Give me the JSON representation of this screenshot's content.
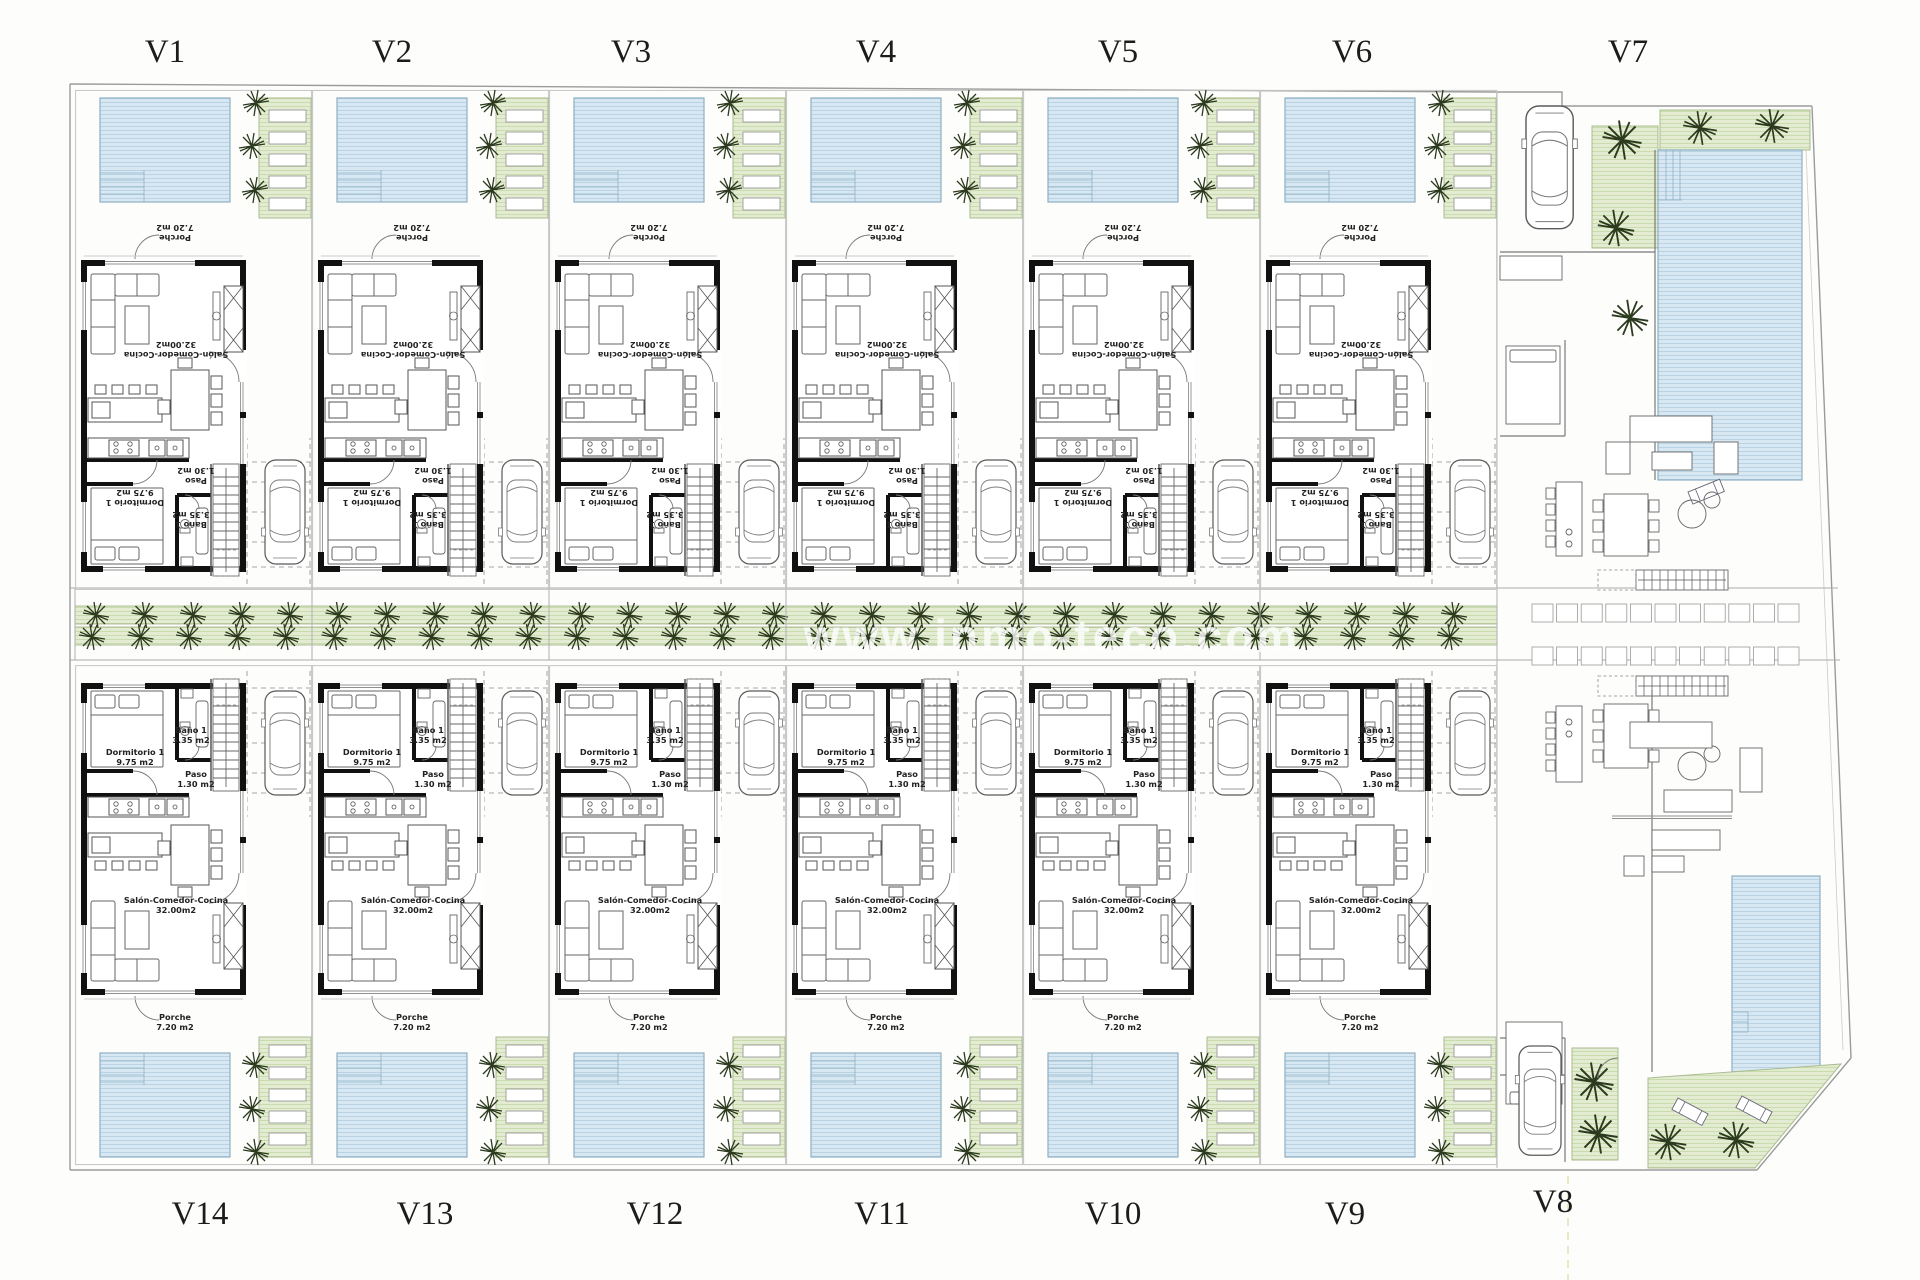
{
  "watermark": "www.inmo-teco.com",
  "plots": {
    "top": [
      "V1",
      "V2",
      "V3",
      "V4",
      "V5",
      "V6",
      "V7"
    ],
    "bottom": [
      "V14",
      "V13",
      "V12",
      "V11",
      "V10",
      "V9",
      "V8"
    ]
  },
  "unit_rooms": {
    "dormitorio": {
      "name": "Dormitorio 1",
      "area": "9.75 m2"
    },
    "bano": {
      "name": "Baño 1",
      "area": "3.35 m2"
    },
    "paso": {
      "name": "Paso",
      "area": "1.30 m2"
    },
    "salon": {
      "name": "Salón-Comedor-Cocina",
      "area": "32.00m2"
    },
    "porche": {
      "name": "Porche",
      "area": "7.20 m2"
    }
  },
  "colors": {
    "pool": "#d8e8f3",
    "pool_line": "#b9d3e4",
    "grass": "#e3ecd3",
    "grass_line": "#c9dcab",
    "wall": "#111111",
    "tree": "#2c3a1e",
    "watermark": "#ffffff"
  }
}
